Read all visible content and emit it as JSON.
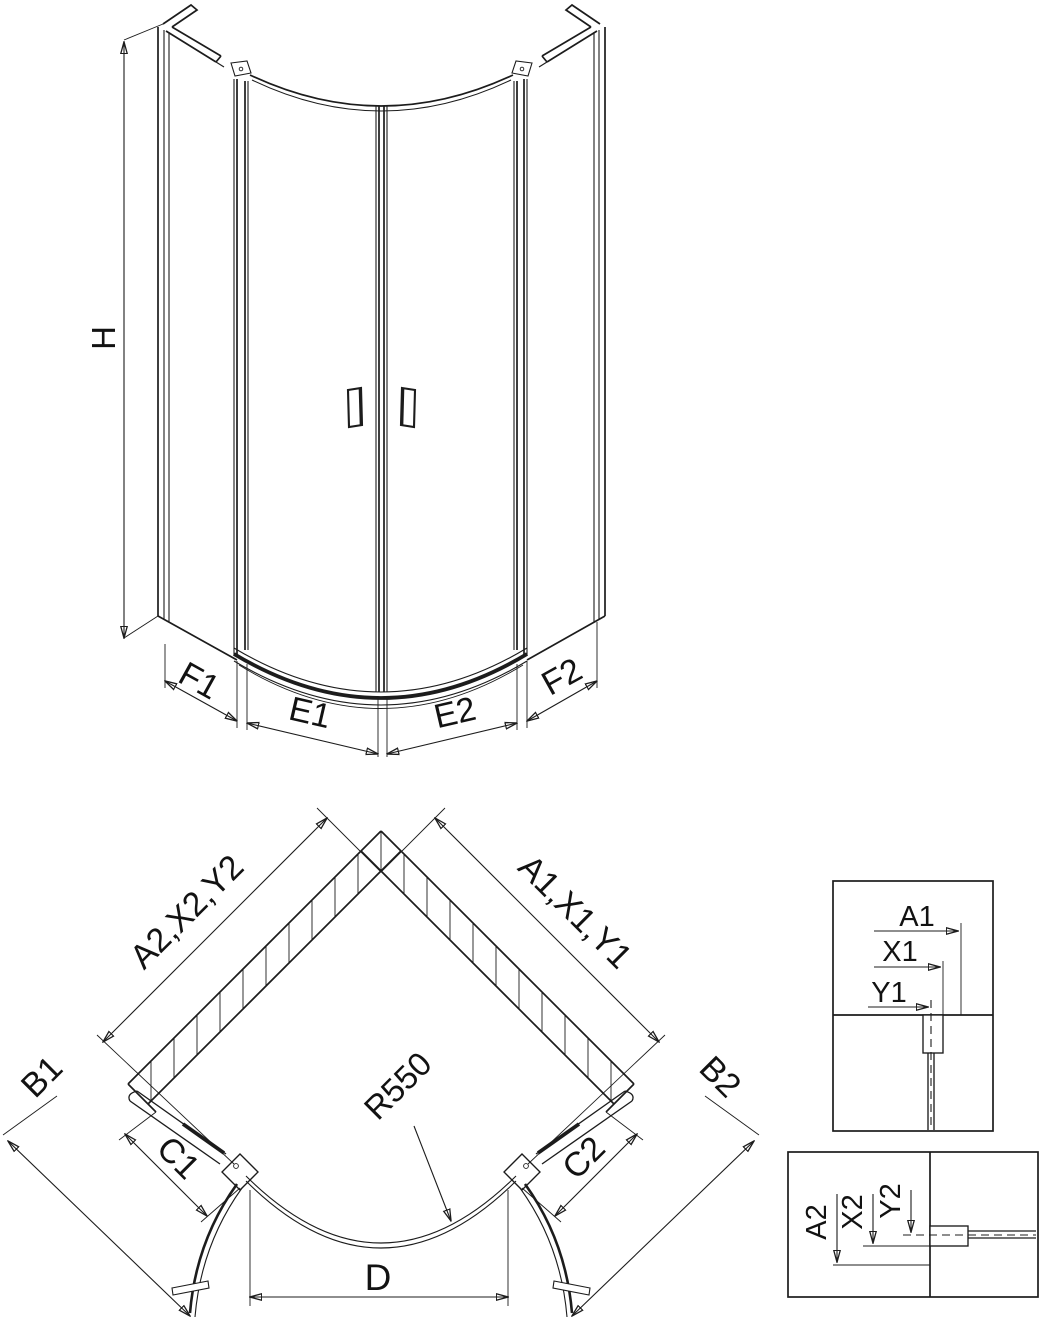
{
  "elevation": {
    "height": "H",
    "f1": "F1",
    "e1": "E1",
    "e2": "E2",
    "f2": "F2"
  },
  "plan": {
    "left_wall": "A2,X2,Y2",
    "right_wall": "A1,X1,Y1",
    "b1": "B1",
    "b2": "B2",
    "c1": "C1",
    "c2": "C2",
    "d": "D",
    "radius": "R550"
  },
  "detail_top": {
    "a": "A1",
    "x": "X1",
    "y": "Y1"
  },
  "detail_bottom": {
    "a": "A2",
    "x": "X2",
    "y": "Y2"
  },
  "colors": {
    "line": "#1c1c1c",
    "text": "#121212",
    "background": "#ffffff"
  }
}
